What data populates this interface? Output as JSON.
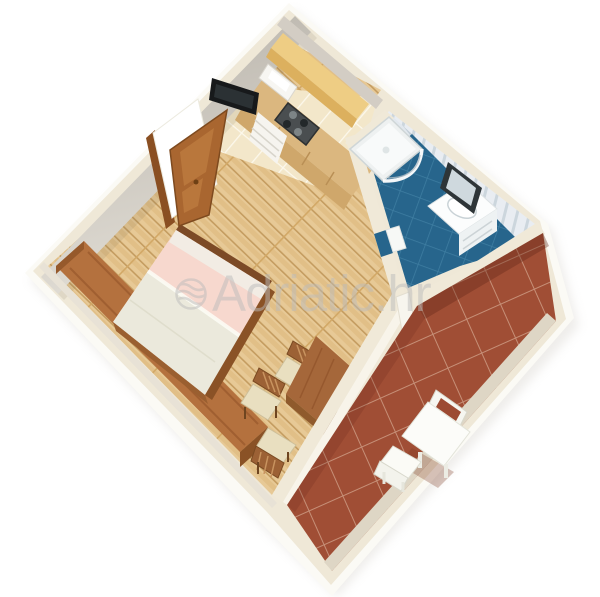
{
  "watermark": {
    "text": "Adriatic.hr",
    "logo": "adriatic-waves-logo",
    "color": "#bcbcbc",
    "opacity": 0.5
  },
  "scene": {
    "type": "3d-floor-plan-render",
    "subject": "Isometric 3D cutaway floor plan of a studio apartment",
    "rooms": [
      {
        "name": "living-bedroom",
        "floor": "light-wood-planks",
        "items": [
          "double-bed-pink-bedding",
          "wall-long-desk",
          "dining-table",
          "dining-chairs",
          "wall-mounted-tv",
          "wooden-entry-door",
          "kitchenette-counter",
          "cooktop",
          "upper-cabinet-shelf",
          "ceramic-entry-tiles"
        ]
      },
      {
        "name": "bathroom",
        "floor": "blue-diagonal-tiles",
        "items": [
          "corner-shower",
          "vanity-sink",
          "framed-mirror",
          "bathroom-door"
        ]
      },
      {
        "name": "terrace",
        "floor": "terracotta-diagonal-tiles",
        "items": [
          "white-patio-table",
          "white-patio-chairs"
        ]
      }
    ],
    "palette": {
      "background": "#ffffff",
      "wall_top": "#efe8d7",
      "wall_outer": "#fbfaf5",
      "wall_face_shadow": "#c6c1b8",
      "wood_floor": "#e7c996",
      "entry_tile": "#f3e7ca",
      "terrace_tile": "#a04e35",
      "bathroom_floor": "#27658c",
      "bathroom_wall": "#e9edf2",
      "bed_pink": "#f7d8ce",
      "bed_sheet": "#ebe9dc",
      "furniture_wood": "#b1703e",
      "door_wood": "#a96630",
      "kitchen_shelf": "#eecd84",
      "tv_black": "#17191b",
      "white_furniture": "#fcfcf9"
    }
  }
}
